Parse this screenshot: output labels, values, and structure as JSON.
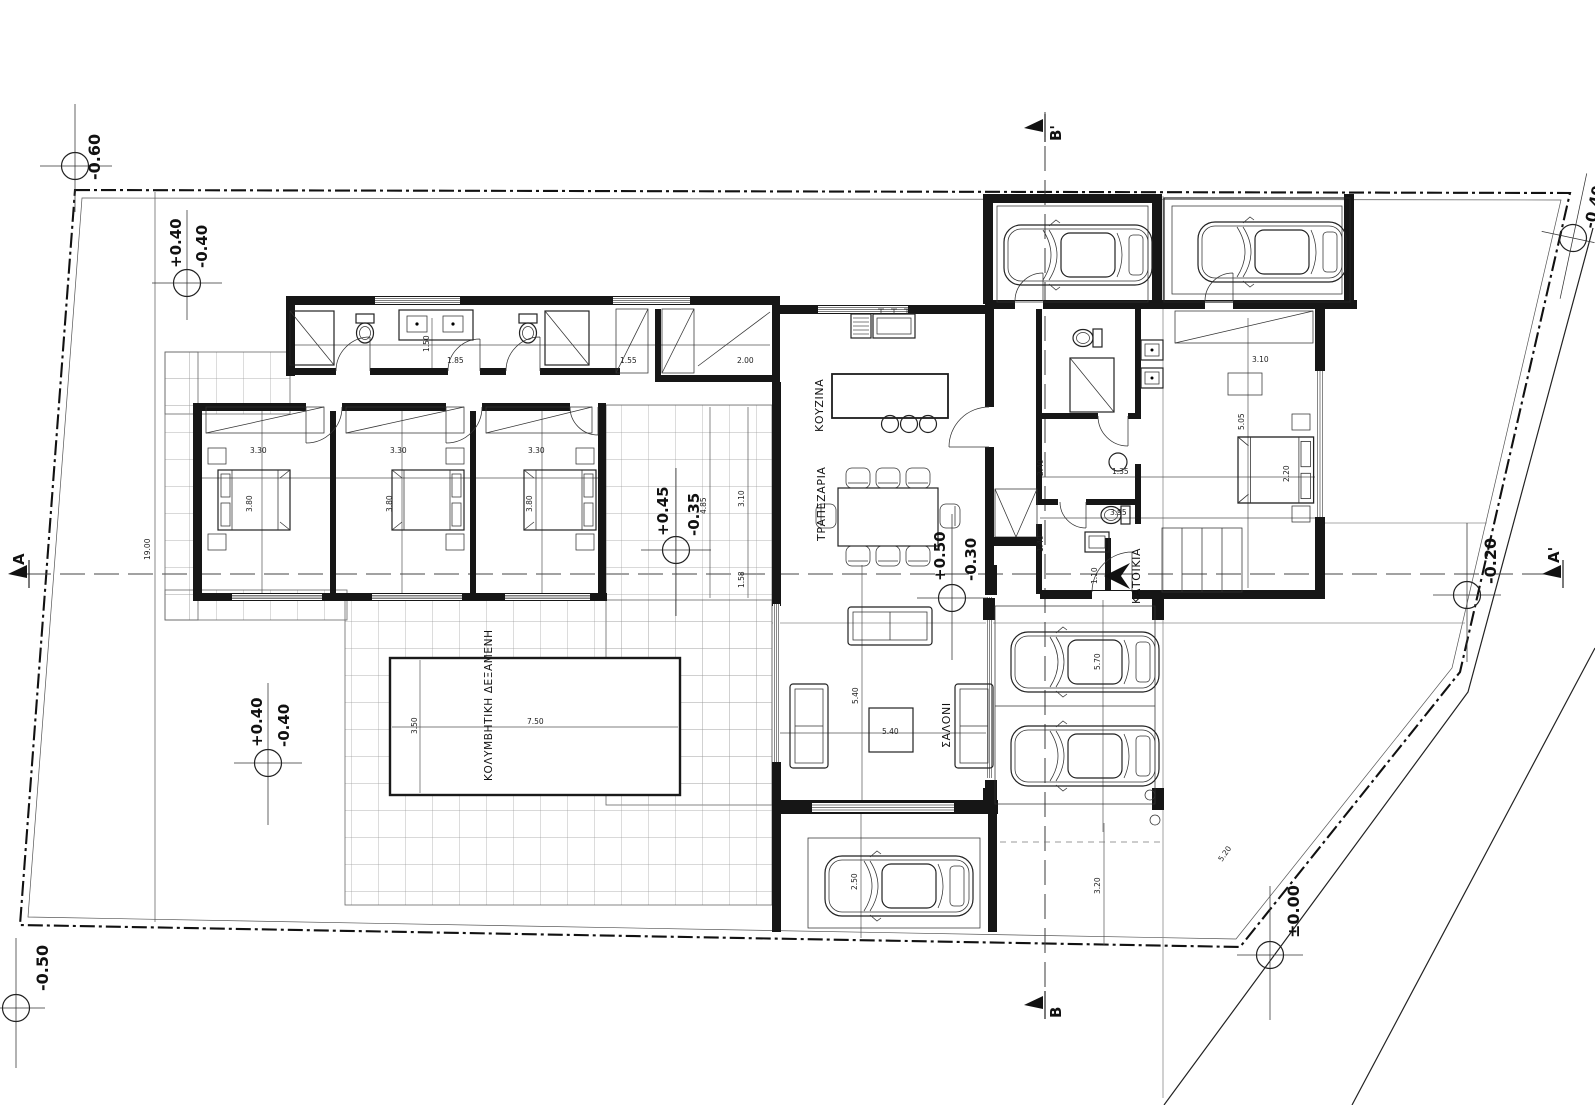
{
  "rooms": {
    "kitchen": "ΚΟΥΖΙΝΑ",
    "dining": "ΤΡΑΠΕΖΑΡΙΑ",
    "living": "ΣΑΛΟΝΙ",
    "residence": "ΚΑΤΟΙΚΙΑ",
    "pool": "ΚΟΛΥΜΒΗΤΙΚΗ ΔΕΞΑΜΕΝΗ"
  },
  "sections": {
    "a": "A",
    "a_prime": "A'",
    "b": "B",
    "b_prime": "B'"
  },
  "levels": [
    {
      "value": "-0.60"
    },
    {
      "upper": "+0.40",
      "lower": "-0.40"
    },
    {
      "value": "-0.40"
    },
    {
      "upper": "+0.45",
      "lower": "-0.35"
    },
    {
      "upper": "+0.50",
      "lower": "-0.30"
    },
    {
      "value": "-0.20"
    },
    {
      "value": "±0.00"
    },
    {
      "value": "-0.50"
    },
    {
      "upper": "+0.40",
      "lower": "-0.40"
    }
  ],
  "dims": [
    {
      "t": "19.00"
    },
    {
      "t": "3.80"
    },
    {
      "t": "3.30"
    },
    {
      "t": "3.80"
    },
    {
      "t": "3.30"
    },
    {
      "t": "3.80"
    },
    {
      "t": "3.30"
    },
    {
      "t": "4.85"
    },
    {
      "t": "3.10"
    },
    {
      "t": "1.58"
    },
    {
      "t": "3.50"
    },
    {
      "t": "7.50"
    },
    {
      "t": "5.40"
    },
    {
      "t": "5.40"
    },
    {
      "t": "5.70"
    },
    {
      "t": "2.50"
    },
    {
      "t": "3.20"
    },
    {
      "t": "5.05"
    },
    {
      "t": "3.10"
    },
    {
      "t": "1.35"
    },
    {
      "t": "3.95"
    },
    {
      "t": "2.40"
    },
    {
      "t": "1.40"
    },
    {
      "t": "1.50"
    },
    {
      "t": "2.00"
    },
    {
      "t": "1.55"
    },
    {
      "t": "2.20"
    },
    {
      "t": "5.20"
    },
    {
      "t": "1.10"
    },
    {
      "t": "1.85"
    }
  ]
}
